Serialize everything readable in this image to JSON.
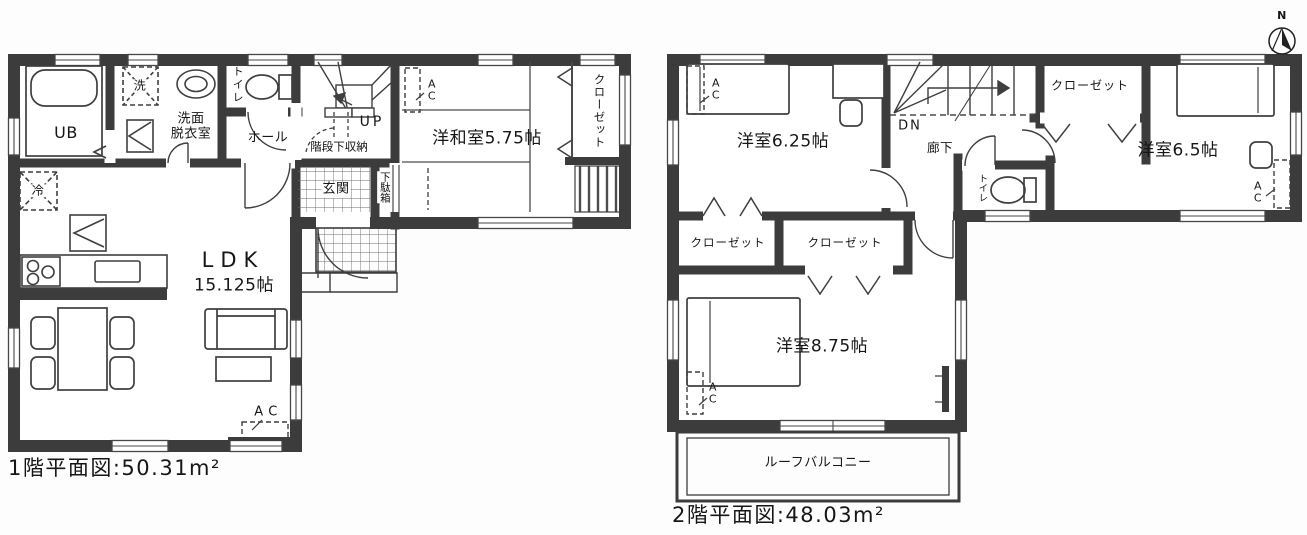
{
  "compass": {
    "north_label": "N"
  },
  "floor1": {
    "caption": "1階平面図:50.31m²",
    "labels": {
      "ub": "UB",
      "washer": "洗",
      "fridge": "冷",
      "washroom": "洗面\n脱衣室",
      "toilet": "トイレ",
      "hall": "ホール",
      "up": "UP",
      "under_stair_storage": "階段下収納",
      "genkan": "玄関",
      "shoe_cabinet": "下駄箱",
      "tatami_room": "洋和室5.75帖",
      "closet": "クローゼット",
      "ldk": "LDK",
      "ldk_size": "15.125帖",
      "ac_tatami": "A\nC",
      "ac_ldk": "A C"
    }
  },
  "floor2": {
    "caption": "2階平面図:48.03m²",
    "labels": {
      "bedroom_6_25": "洋室6.25帖",
      "bedroom_6_5": "洋室6.5帖",
      "bedroom_8_75": "洋室8.75帖",
      "closet_a": "クローゼット",
      "closet_b": "クローゼット",
      "closet_top": "クローゼット",
      "dn": "DN",
      "corridor": "廊下",
      "toilet": "トイレ",
      "roof_balcony": "ルーフバルコニー",
      "ac_6_25": "A\nC",
      "ac_6_5": "A\nC",
      "ac_8_75": "A\nC"
    }
  }
}
